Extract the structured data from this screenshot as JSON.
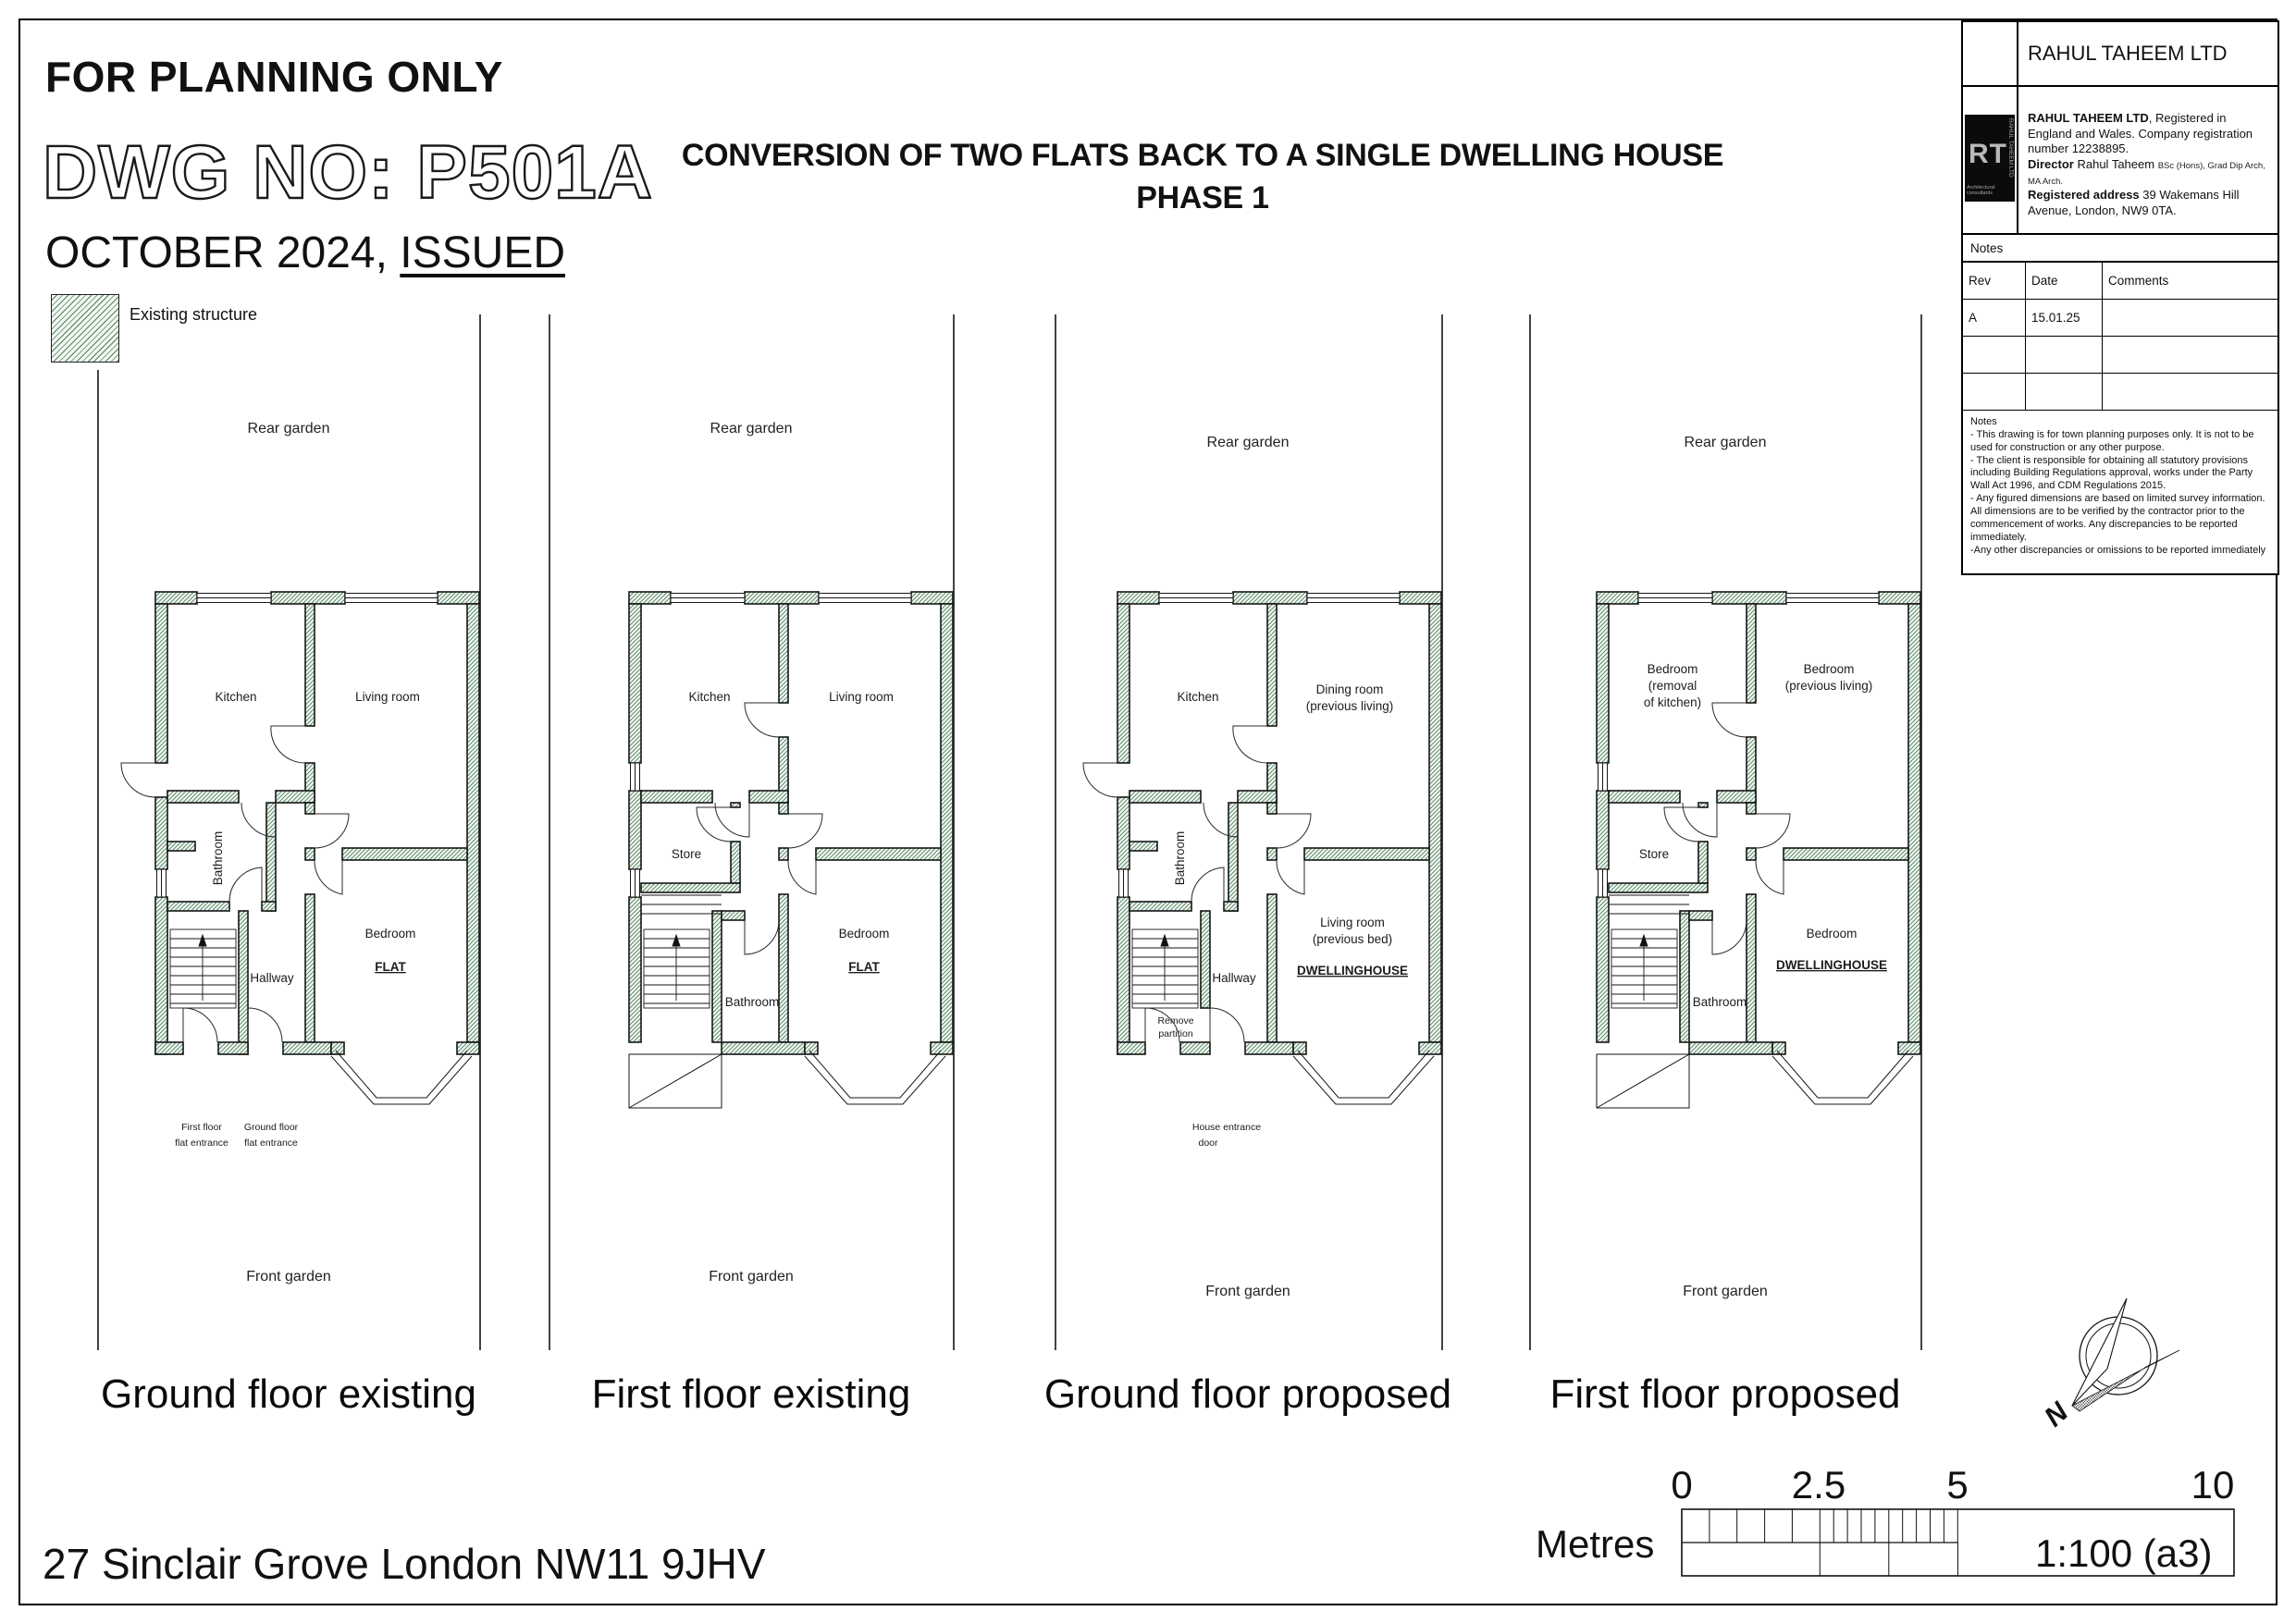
{
  "header": {
    "for_planning": "FOR PLANNING ONLY",
    "dwg_no": "DWG NO: P501A",
    "date_line": "OCTOBER 2024, ",
    "issued": "ISSUED",
    "title_line1": "CONVERSION OF TWO FLATS BACK TO A SINGLE DWELLING HOUSE",
    "title_line2": "PHASE 1"
  },
  "legend": {
    "existing_structure": "Existing structure"
  },
  "title_block": {
    "company_name": "RAHUL TAHEEM LTD",
    "logo": {
      "rt": "RT",
      "sub": "Architectural consultants",
      "side": "RAHUL TAHEEM LTD"
    },
    "info": {
      "b1": "RAHUL TAHEEM LTD",
      "t1": ", Registered in England and Wales. Company registration number 12238895.",
      "b2": "Director",
      "t2": " Rahul Taheem ",
      "small": "BSc (Hons), Grad Dip Arch, MA Arch.",
      "b3": "Registered address",
      "t3": " 39 Wakemans Hill Avenue, London, NW9 0TA."
    },
    "notes_label": "Notes",
    "rev_table": {
      "headers": [
        "Rev",
        "Date",
        "Comments"
      ],
      "rows": [
        [
          "A",
          "15.01.25",
          ""
        ],
        [
          "",
          "",
          ""
        ],
        [
          "",
          "",
          ""
        ]
      ]
    },
    "notes_title": "Notes",
    "notes_lines": [
      "- This drawing is for town planning purposes only. It is not to be used for construction or any other purpose.",
      "- The client is responsible for obtaining all statutory provisions including Building Regulations approval, works under the Party Wall Act 1996, and CDM Regulations 2015.",
      "- Any figured dimensions are based on limited survey information. All dimensions are to be verified by the contractor prior to the commencement of works. Any discrepancies to be reported immediately.",
      "-Any other discrepancies or omissions to be reported immediately"
    ]
  },
  "plans": {
    "p1": {
      "caption": "Ground floor existing",
      "rear": "Rear garden",
      "front": "Front garden",
      "kitchen": "Kitchen",
      "living": "Living room",
      "bathroom": "Bathroom",
      "hallway": "Hallway",
      "bedroom": "Bedroom",
      "tag": "FLAT",
      "ent1a": "First floor",
      "ent1b": "flat entrance",
      "ent2a": "Ground floor",
      "ent2b": "flat entrance"
    },
    "p2": {
      "caption": "First floor existing",
      "rear": "Rear garden",
      "front": "Front garden",
      "kitchen": "Kitchen",
      "living": "Living room",
      "store": "Store",
      "bathroom": "Bathroom",
      "bedroom": "Bedroom",
      "tag": "FLAT"
    },
    "p3": {
      "caption": "Ground floor proposed",
      "rear": "Rear garden",
      "front": "Front garden",
      "kitchen": "Kitchen",
      "dining1": "Dining room",
      "dining2": "(previous living)",
      "bathroom": "Bathroom",
      "hallway": "Hallway",
      "living1": "Living room",
      "living2": "(previous bed)",
      "tag": "DWELLINGHOUSE",
      "rem1": "Remove",
      "rem2": "partition",
      "ent1": "House entrance",
      "ent2": "door"
    },
    "p4": {
      "caption": "First floor proposed",
      "rear": "Rear garden",
      "front": "Front garden",
      "bed1a": "Bedroom",
      "bed1b": "(removal",
      "bed1c": "of kitchen)",
      "bed2a": "Bedroom",
      "bed2b": "(previous living)",
      "store": "Store",
      "bathroom": "Bathroom",
      "bed3": "Bedroom",
      "tag": "DWELLINGHOUSE"
    }
  },
  "footer": {
    "address": "27 Sinclair Grove London NW11 9JHV"
  },
  "scale_bar": {
    "ticks": [
      "0",
      "2.5",
      "5",
      "10"
    ],
    "unit": "Metres",
    "ratio": "1:100 (a3)"
  },
  "north": {
    "label": "N"
  },
  "colors": {
    "hatch_line": "#4d7f5c",
    "hatch_bg": "#f1f7f1",
    "line": "#111111"
  }
}
